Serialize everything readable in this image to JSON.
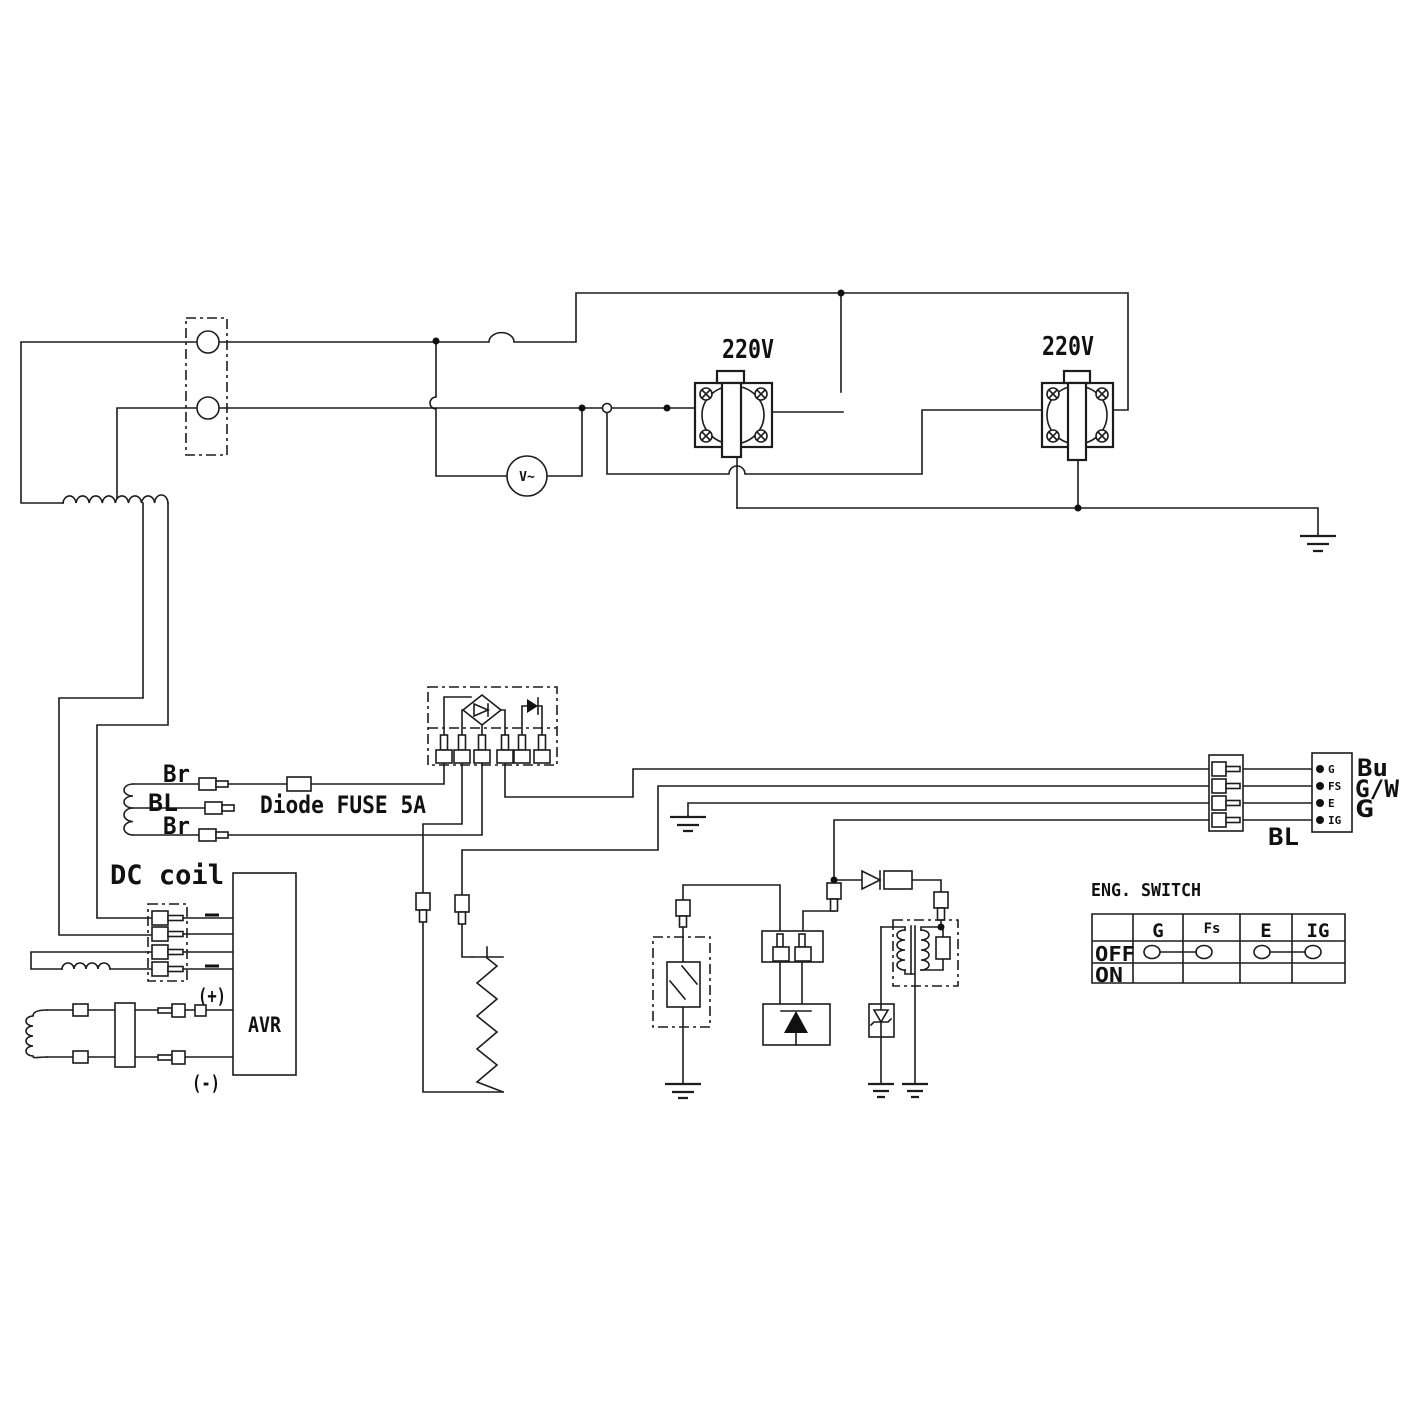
{
  "outlets": {
    "outlet1_voltage": "220V",
    "outlet2_voltage": "220V"
  },
  "voltmeter": {
    "label": "V~"
  },
  "dc_coil": {
    "title": "DC coil",
    "wire_labels": [
      "Br",
      "BL",
      "Br"
    ],
    "fuse_label": "Diode FUSE 5A"
  },
  "avr": {
    "label": "AVR",
    "plus": "(+)",
    "minus": "(-)"
  },
  "connector": {
    "pins": [
      {
        "terminal": "G",
        "wire_color": "Bu"
      },
      {
        "terminal": "FS",
        "wire_color": "G/W"
      },
      {
        "terminal": "E",
        "wire_color": "G"
      },
      {
        "terminal": "IG",
        "wire_color": ""
      }
    ],
    "harness_label": "BL"
  },
  "eng_switch": {
    "title": "ENG. SWITCH",
    "col_headers": [
      "G",
      "Fs",
      "E",
      "IG"
    ],
    "rows": [
      {
        "label": "OFF",
        "closed_pairs": [
          [
            "G",
            "Fs"
          ],
          [
            "E",
            "IG"
          ]
        ]
      },
      {
        "label": "ON",
        "closed_pairs": []
      }
    ]
  }
}
